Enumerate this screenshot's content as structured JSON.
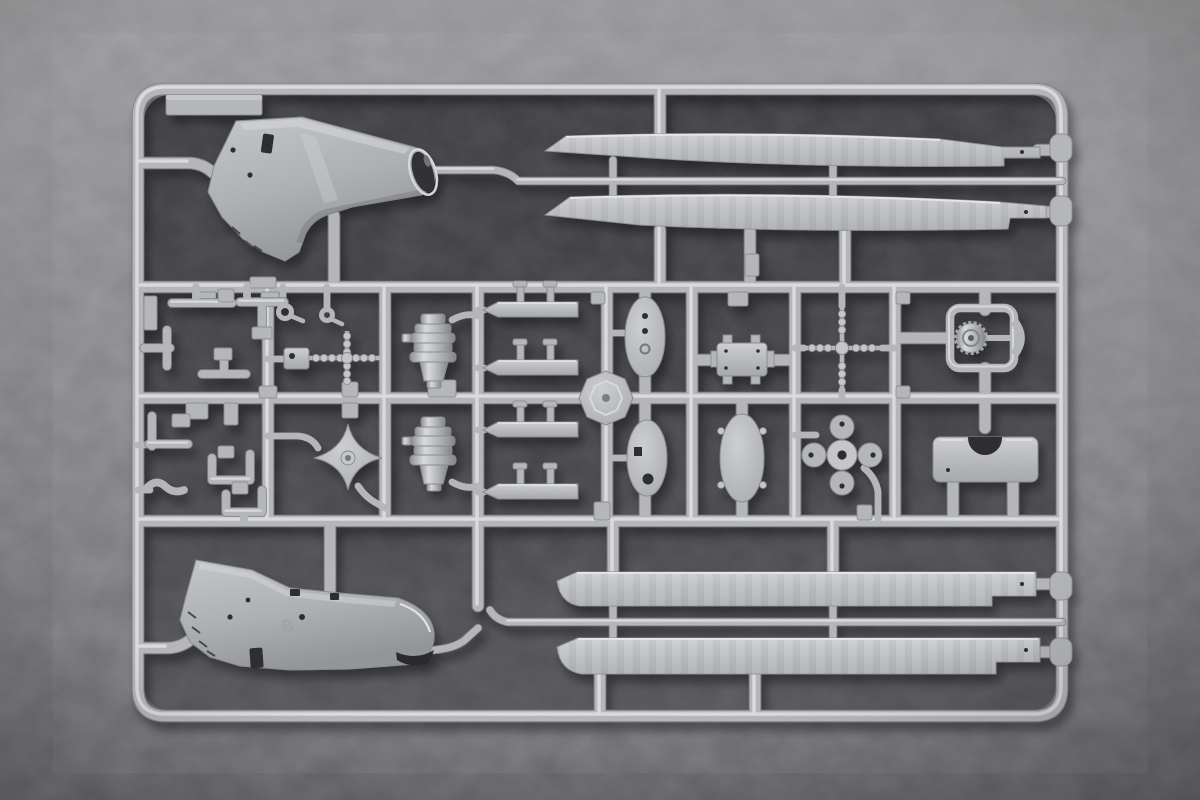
{
  "scene": {
    "subject": "plastic model kit sprue photographed on dark grey fabric",
    "type": "photograph",
    "markings": {
      "embossed_letter": "B"
    },
    "colors": {
      "bg-top": "#919193",
      "bg-bottom": "#5e5e62",
      "fabric-inner": "#3b3b3f",
      "plastic-base": "#b2b4b6",
      "plastic-mid": "#c3c5c6",
      "plastic-hi": "#e2e4e5",
      "plastic-edge": "#7e8083",
      "opening-dark": "#28282b"
    },
    "parts": [
      {
        "name": "sprue-frame",
        "count": 1,
        "location": "perimeter"
      },
      {
        "name": "engine-nacelle-fairing-upper",
        "count": 1,
        "location": "top-left"
      },
      {
        "name": "engine-nacelle-fairing-lower",
        "count": 1,
        "location": "bottom-left"
      },
      {
        "name": "main-rotor-blade",
        "count": 4,
        "location": "top-right and bottom-right pairs"
      },
      {
        "name": "turbine-engine-body",
        "count": 2,
        "location": "center-left column"
      },
      {
        "name": "step-strip",
        "count": 4,
        "location": "center column"
      },
      {
        "name": "oval-access-panel",
        "count": 2,
        "location": "center"
      },
      {
        "name": "oval-fairing-panel",
        "count": 1,
        "location": "center-right"
      },
      {
        "name": "octagonal-hub-plate",
        "count": 1,
        "location": "center"
      },
      {
        "name": "gearbox-block",
        "count": 1,
        "location": "center-right"
      },
      {
        "name": "beaded-rotor-shaft-cross",
        "count": 1,
        "location": "right of center"
      },
      {
        "name": "four-lobe-swashplate",
        "count": 1,
        "location": "lower right of center"
      },
      {
        "name": "wheel-in-frame",
        "count": 1,
        "location": "upper right column"
      },
      {
        "name": "notched-mount-plate",
        "count": 1,
        "location": "lower right column"
      },
      {
        "name": "four-point-star-hub",
        "count": 1,
        "location": "lower left-center"
      },
      {
        "name": "small-brackets-and-levers",
        "count": 12,
        "location": "left cells"
      }
    ]
  }
}
